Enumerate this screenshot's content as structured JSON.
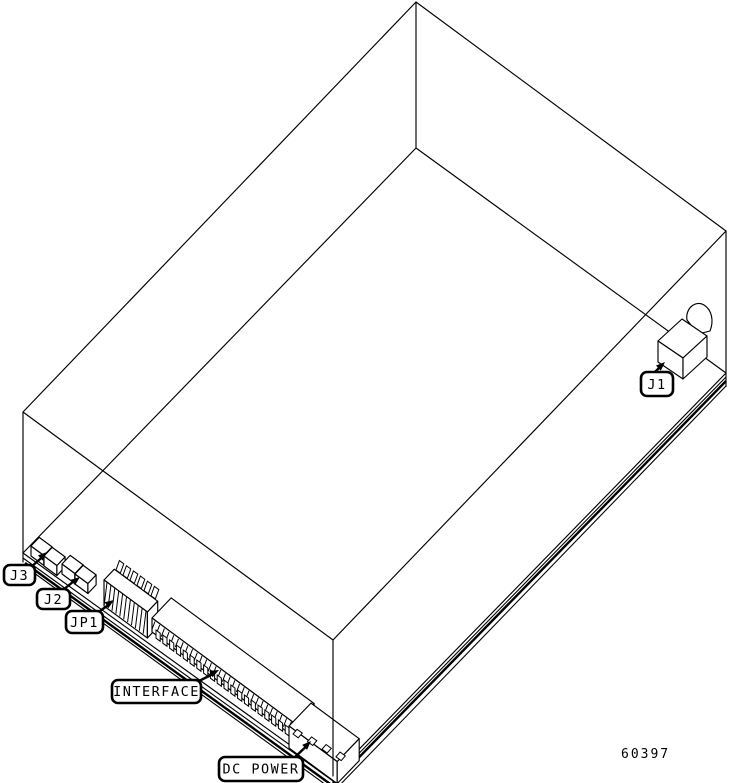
{
  "figure": {
    "number": "60397",
    "labels": {
      "j3": "J3",
      "j2": "J2",
      "jp1": "JP1",
      "interface": "INTERFACE",
      "dc_power": "DC POWER",
      "j1": "J1"
    }
  },
  "colors": {
    "line": "#000000",
    "background": "#ffffff"
  }
}
